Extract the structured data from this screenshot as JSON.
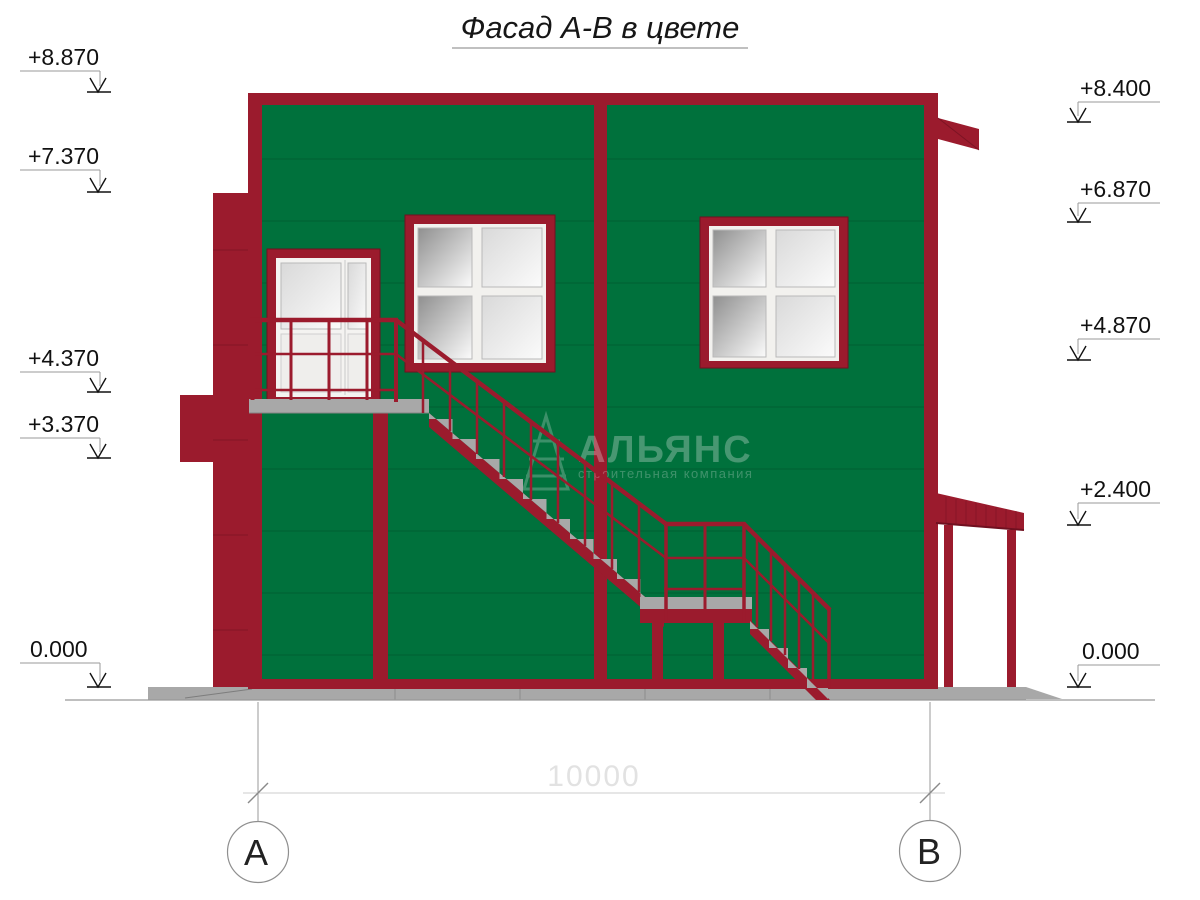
{
  "title": "Фасад А-В в цвете",
  "elevations": {
    "left": [
      "+8.870",
      "+7.370",
      "+4.370",
      "+3.370",
      "0.000"
    ],
    "right": [
      "+8.400",
      "+6.870",
      "+4.870",
      "+2.400",
      "0.000"
    ]
  },
  "axes": {
    "left_label": "А",
    "right_label": "В",
    "span_dimension": "10000"
  },
  "watermark": {
    "company": "АЛЬЯНС",
    "tagline": "строительная компания"
  },
  "colors": {
    "wall_green": "#00713C",
    "wall_seam": "#004F29",
    "trim_red": "#9B1B2D",
    "trim_red_dark": "#701020",
    "concrete": "#A8A8A8",
    "concrete_dark": "#858585",
    "glass_dark": "#8F8F8F",
    "glass_mid": "#D9D9D9",
    "glass_light": "#FBFBFB",
    "line_gray": "#9A9A9A",
    "dim_text": "#E2E2E2",
    "ink": "#111111"
  }
}
